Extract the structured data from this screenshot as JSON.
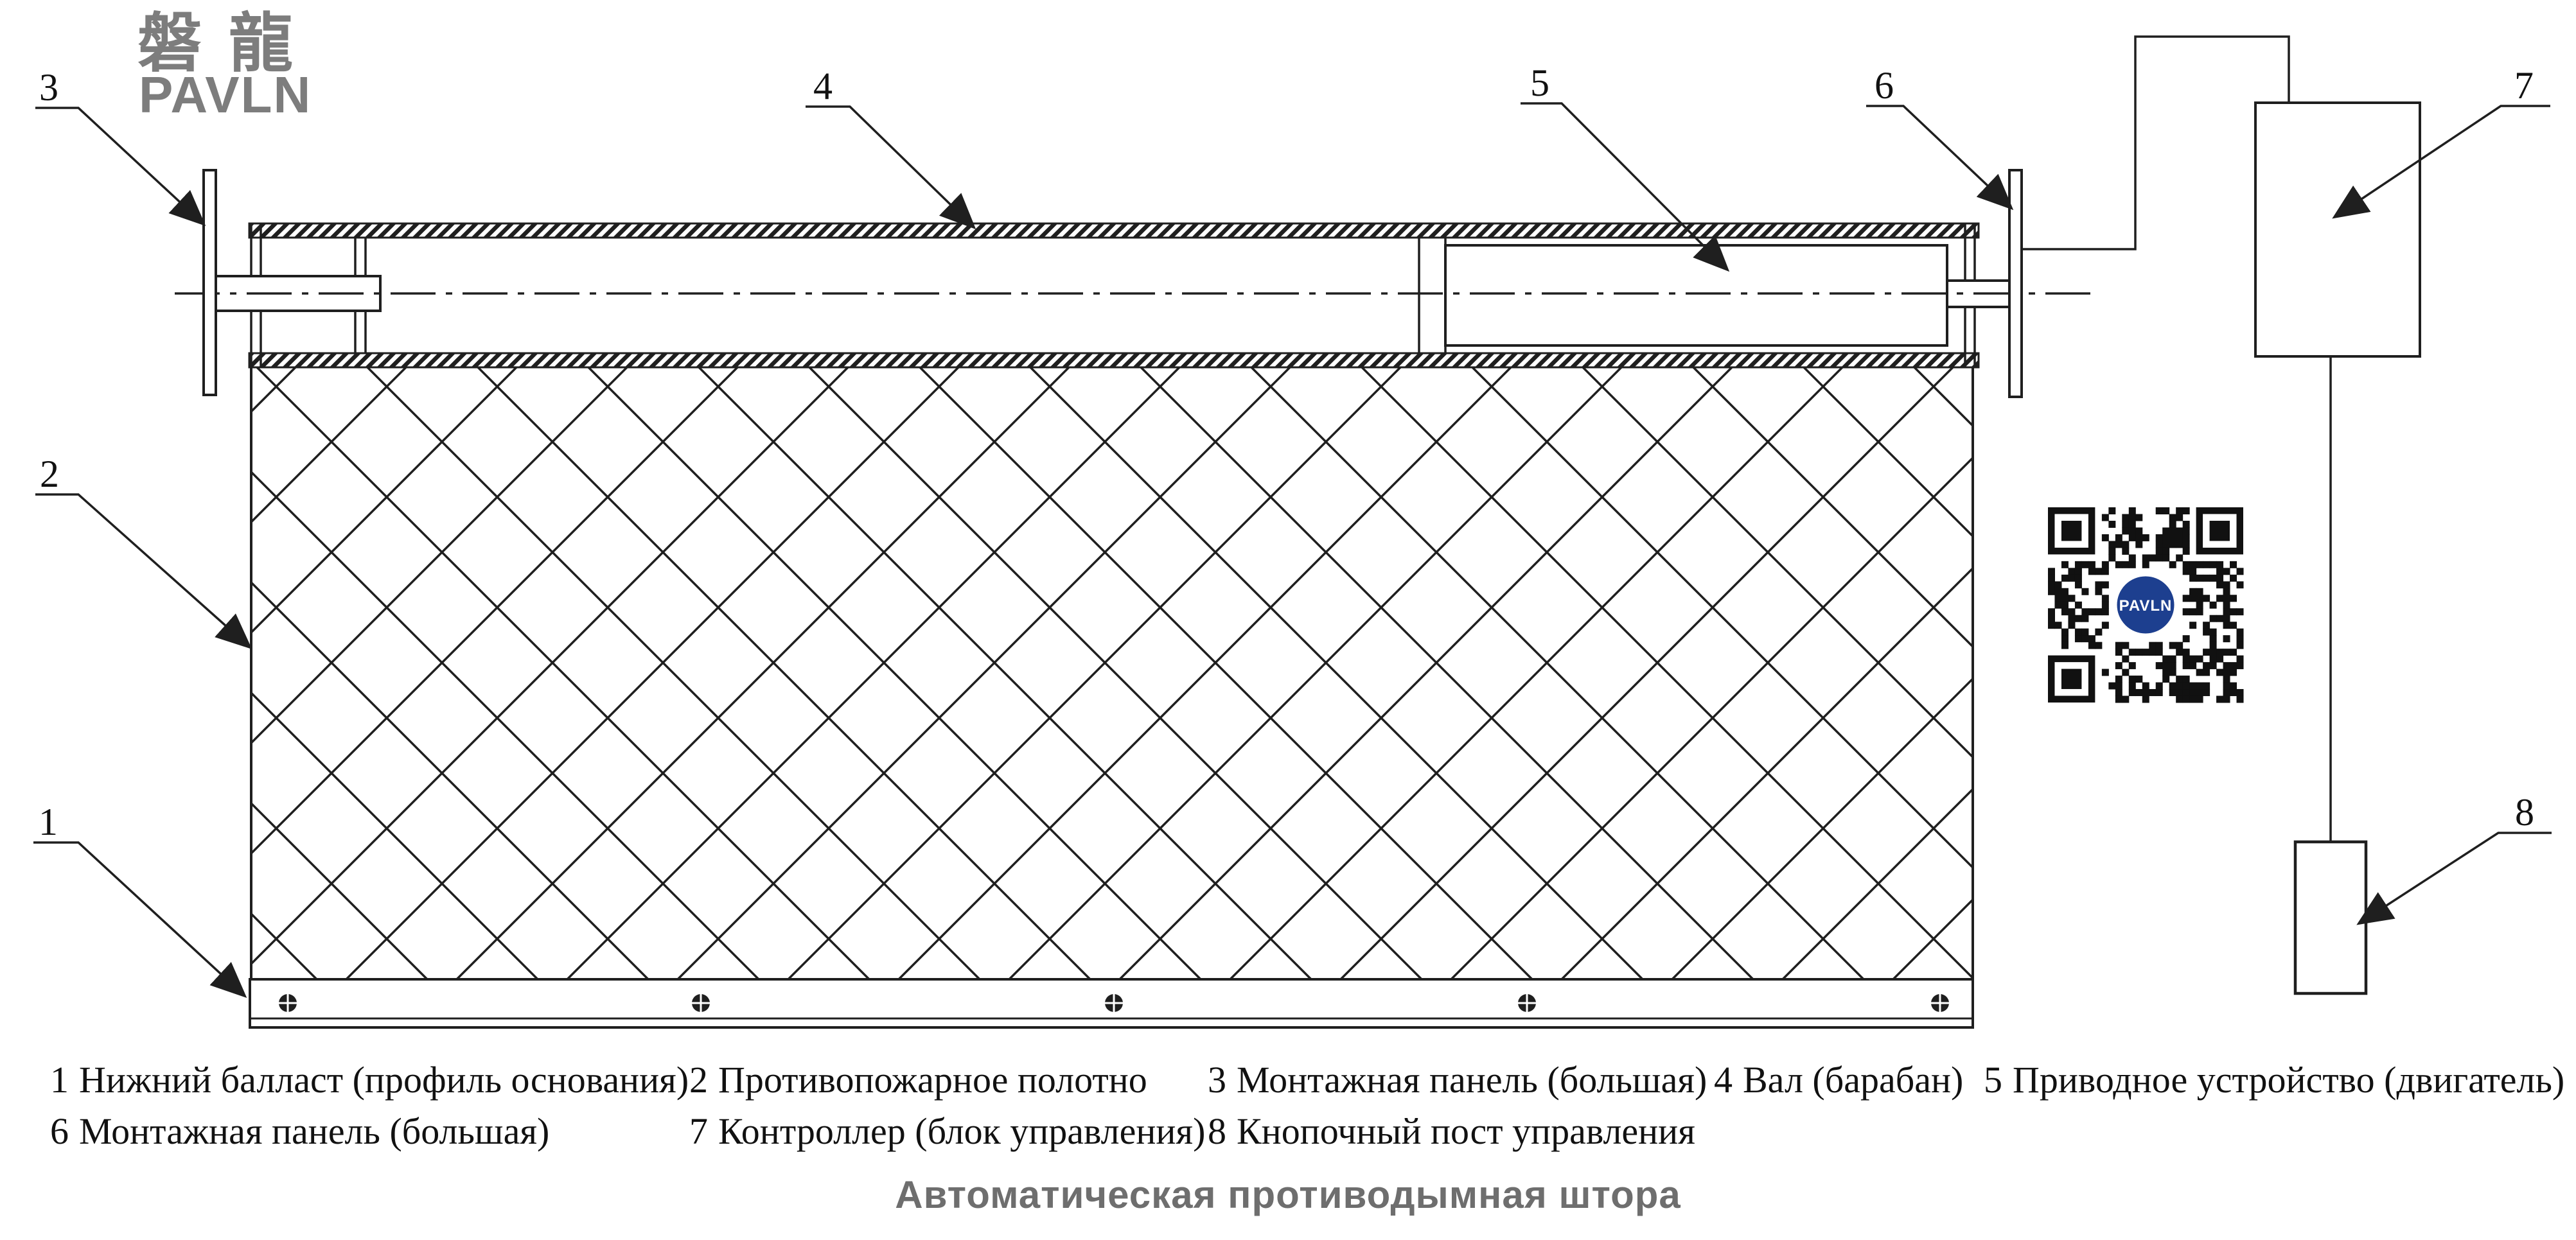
{
  "logo": {
    "cjk": "磐龍",
    "latin": "PAVLN"
  },
  "callouts": {
    "c1": "1",
    "c2": "2",
    "c3": "3",
    "c4": "4",
    "c5": "5",
    "c6": "6",
    "c7": "7",
    "c8": "8"
  },
  "legend": {
    "row1": [
      {
        "num": "1",
        "label": "Нижний балласт (профиль основания)"
      },
      {
        "num": "2",
        "label": "Противопожарное полотно"
      },
      {
        "num": "3",
        "label": "Монтажная панель (большая)"
      },
      {
        "num": "4",
        "label": "Вал (барабан)"
      },
      {
        "num": "5",
        "label": "Приводное устройство (двигатель)"
      }
    ],
    "row2": [
      {
        "num": "6",
        "label": "Монтажная панель (большая)"
      },
      {
        "num": "7",
        "label": "Контроллер (блок управления)"
      },
      {
        "num": "8",
        "label": "Кнопочный пост управления"
      }
    ]
  },
  "title": "Автоматическая противодымная штора",
  "qr": {
    "center_label": "PAVLN"
  },
  "colors": {
    "line": "#1f1f1f",
    "logo_gray": "#7d7d7d",
    "title_gray": "#6e6e6e",
    "qr_navy": "#1d3f8f"
  }
}
